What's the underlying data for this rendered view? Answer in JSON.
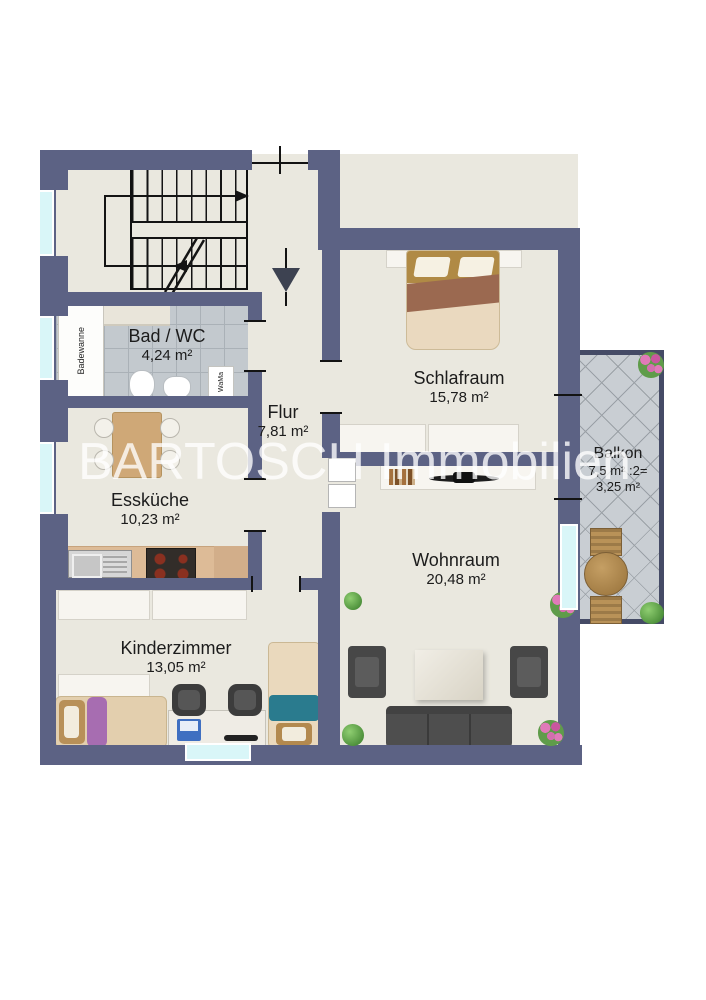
{
  "watermark": {
    "text": "BARTOSCH Immobilien"
  },
  "rooms": {
    "bad": {
      "name": "Bad / WC",
      "area": "4,24 m²"
    },
    "flur": {
      "name": "Flur",
      "area": "7,81 m²"
    },
    "schlafraum": {
      "name": "Schlafraum",
      "area": "15,78 m²"
    },
    "esskueche": {
      "name": "Essküche",
      "area": "10,23 m²"
    },
    "wohnraum": {
      "name": "Wohnraum",
      "area": "20,48 m²"
    },
    "kinderzimmer": {
      "name": "Kinderzimmer",
      "area": "13,05 m²"
    },
    "balkon": {
      "name": "Balkon",
      "calc": "7,5 m² :2=",
      "area": "3,25 m²"
    }
  },
  "labels": {
    "bathtub": "Badewanne",
    "washing_machine": "WaMa"
  },
  "colors": {
    "wall": "#5c6284",
    "floor": "#eae8df",
    "bath_tile": "#c3c9ce",
    "balcony_tile": "#c9ced3",
    "window_glass": "#d9f6f8",
    "kitchen_counter": "#ddbb97",
    "bed_blanket_brown": "#9b6950",
    "accent_purple": "#a76db1",
    "accent_teal": "#2a7b8e",
    "sofa_gray": "#4e4e4e"
  }
}
